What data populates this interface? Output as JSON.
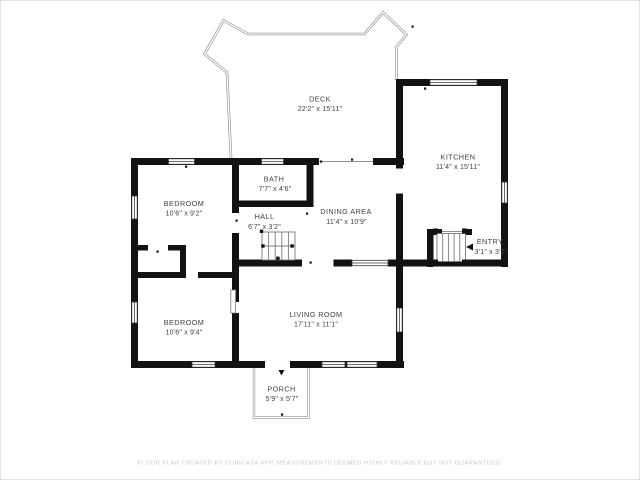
{
  "title": "Floor plan",
  "rooms": [
    {
      "id": "deck",
      "name": "DECK",
      "dims": "22'2\" x 15'11\""
    },
    {
      "id": "kitchen",
      "name": "KITCHEN",
      "dims": "11'4\" x 15'11\""
    },
    {
      "id": "bath",
      "name": "BATH",
      "dims": "7'7\" x 4'6\""
    },
    {
      "id": "bedroom-1",
      "name": "BEDROOM",
      "dims": "10'6\" x 9'2\""
    },
    {
      "id": "hall",
      "name": "HALL",
      "dims": "6'7\" x 3'2\""
    },
    {
      "id": "dining-area",
      "name": "DINING AREA",
      "dims": "11'4\" x 10'9\""
    },
    {
      "id": "entry",
      "name": "ENTRY",
      "dims": "3'1\" x 3'2\""
    },
    {
      "id": "bedroom-2",
      "name": "BEDROOM",
      "dims": "10'6\" x 9'4\""
    },
    {
      "id": "living-room",
      "name": "LIVING ROOM",
      "dims": "17'11\" x 11'1\""
    },
    {
      "id": "porch",
      "name": "PORCH",
      "dims": "5'9\" x 5'7\""
    }
  ],
  "footer": {
    "text": "FLOOR PLAN CREATED BY CUBICASA APP, MEASUREMENTS DEEMED HIGHLY RELIABLE BUT NOT GUARANTEED."
  },
  "colors": {
    "background": "#ffffff",
    "frame": "#e4e4e4",
    "wall": "#121212",
    "thin_line": "#8f8f8f",
    "stair_line": "#7a7a7a",
    "window_stroke": "#3c3c3c",
    "label": "#414141",
    "footer": "#c9c9c9"
  }
}
